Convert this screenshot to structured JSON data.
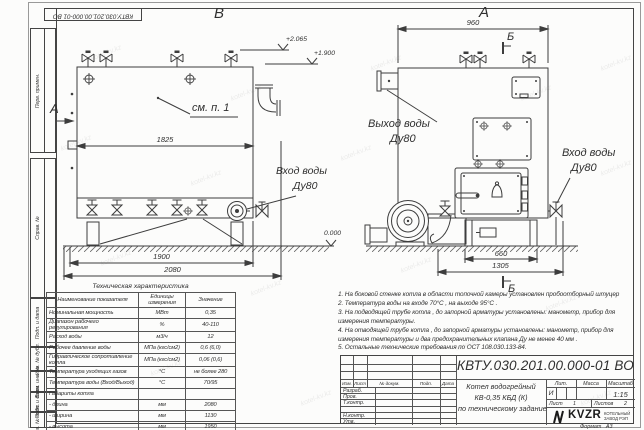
{
  "sheet": {
    "stamp": "КВТУ.030.201.00.000-01 ВО",
    "watermark": "kotel-kv.kz",
    "side_labels": [
      "Перв. примен.",
      "Справ. №",
      "Подп. и дата",
      "Инв. № дубл.",
      "Взам. инв. №",
      "Подп. и дата",
      "Инв. № подл."
    ],
    "format_label": "Формат",
    "format_value": "А3"
  },
  "drawing": {
    "left_view": {
      "view_label": "В",
      "section_arrow_label": "А",
      "callout": "см. п. 1",
      "dim_inner": "1825",
      "dim_legs": "1900",
      "dim_total": "2080",
      "level_top": "+2.065",
      "level_mid": "+1.900",
      "level_zero": "0.000",
      "inlet_line1": "Вход воды",
      "inlet_line2": "Ду80"
    },
    "right_view": {
      "view_label": "А",
      "section_mark_top": "Б",
      "section_mark_bottom": "Б",
      "dim_width": "960",
      "dim_base": "660",
      "dim_total": "1305",
      "outlet_line1": "Выход воды",
      "outlet_line2": "Ду80",
      "inlet_line1": "Вход воды",
      "inlet_line2": "Ду80"
    }
  },
  "spec_table": {
    "title": "Техническая характеристика",
    "col1": "Наименование показателя",
    "col2a": "Единицы",
    "col2b": "измерения",
    "col3": "Значение",
    "rows": [
      [
        "Номинальная мощность",
        "МВт",
        "0,35"
      ],
      [
        "Диапазон рабочего регулирования",
        "%",
        "40-110"
      ],
      [
        "Расход воды",
        "м3/ч",
        "12"
      ],
      [
        "Рабочее давление воды",
        "МПа (кгс/см2)",
        "0,6 (6,0)"
      ],
      [
        "Гидравлическое сопротивление котла",
        "МПа (кгс/см2)",
        "0,06 (0,6)"
      ],
      [
        "Температура уходящих газов",
        "°С",
        "не более 280"
      ],
      [
        "Температура воды (Вход/Выход)",
        "°С",
        "70/95"
      ],
      [
        "Габариты котла",
        "",
        ""
      ],
      [
        "- длина",
        "мм",
        "2080"
      ],
      [
        "- ширина",
        "мм",
        "1130"
      ],
      [
        "- высота",
        "мм",
        "1950"
      ]
    ]
  },
  "notes": {
    "lines": [
      "1.  На боковой стенке котла в области топочной камеры установлен пробоотборный штуцер",
      "2.  Температура воды на входе  70°С ,  на выходе  95°С .",
      "3.  На подводящей трубе котла ,  до запорной арматуры установлены:  манометр,  прибор для",
      "измерения температуры.",
      "4.  На отводящей трубе котла , до запорной арматуры установлены:  манометр,  прибор для",
      "измерения температуры и два предохранительных клапана  Ду не менее  40 мм .",
      "5.  Остальные технические требования по ОСТ  108.030.133-84."
    ]
  },
  "title_block": {
    "designation": "КВТУ.030.201.00.000-01 ВО",
    "name1": "Котел водогрейный",
    "name2": "КВ-0,35 КБД (К)",
    "name3": "по техническому задание",
    "lit_header": "Лит.",
    "mass_header": "Масса",
    "scale_header": "Масштаб",
    "lit_value": "И",
    "scale_value": "1:15",
    "sheet_label": "Лист",
    "sheet_value": "1",
    "sheets_label": "Листов",
    "sheets_value": "2",
    "col_izm": "Изм.",
    "col_list": "Лист",
    "col_doc": "№ докум.",
    "col_sign": "Подп.",
    "col_date": "Дата",
    "row_razrab": "Разраб.",
    "row_prov": "Пров.",
    "row_tkontr": "Т.контр.",
    "row_nkontr": "Н.контр.",
    "row_utv": "Утв.",
    "logo": "KVZR",
    "logo_sub1": "КОТЕЛЬНЫЙ",
    "logo_sub2": "ЗАВОД РЭП"
  }
}
